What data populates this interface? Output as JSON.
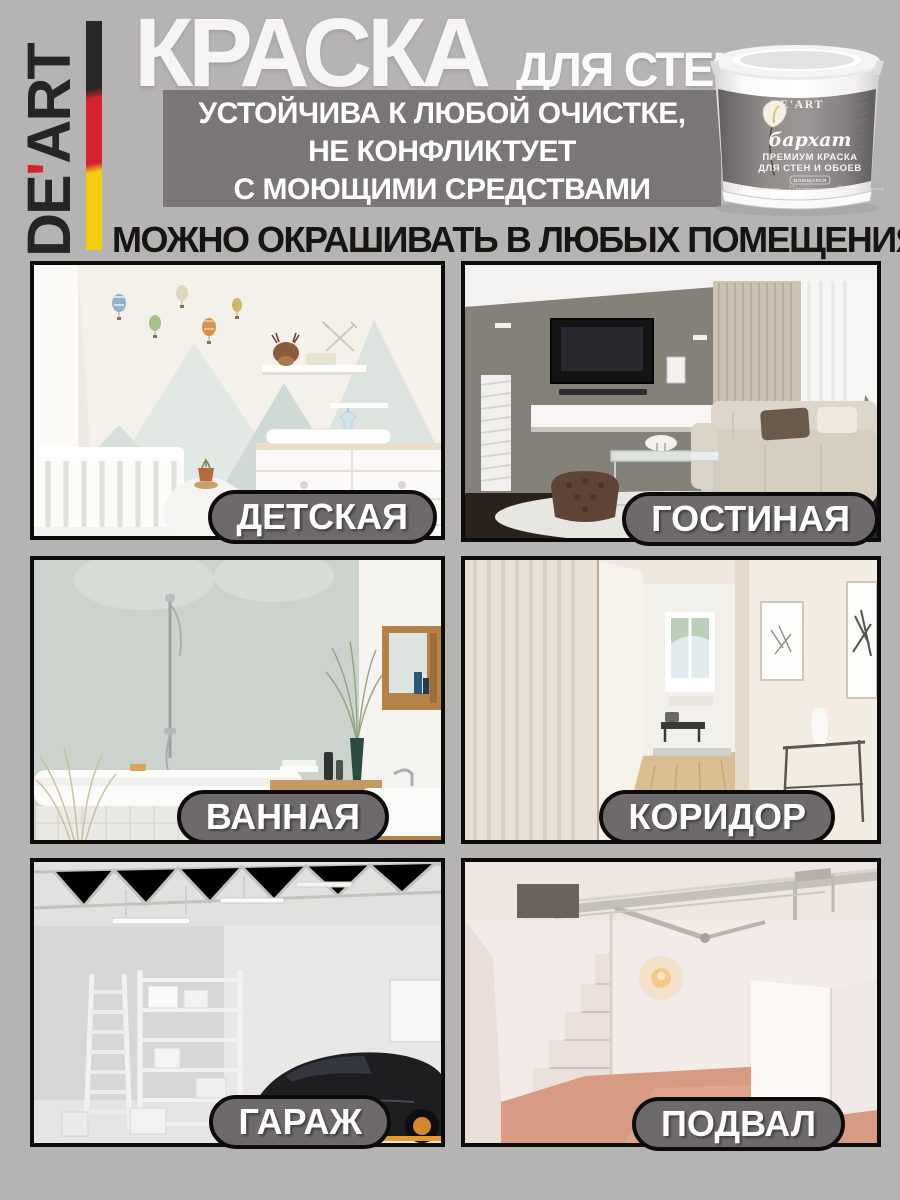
{
  "brand": {
    "name_prefix": "DE",
    "apostrophe": "'",
    "name_suffix": "ART",
    "flag_colors": {
      "black": "#2a2928",
      "red": "#d6212e",
      "yellow": "#f3cf12"
    }
  },
  "header": {
    "title_main": "КРАСКА",
    "title_sub": "ДЛЯ СТЕН",
    "benefit_line1": "УСТОЙЧИВА К ЛЮБОЙ ОЧИСТКЕ,",
    "benefit_line2": "НЕ КОНФЛИКТУЕТ",
    "benefit_line3": "С МОЮЩИМИ СРЕДСТВАМИ",
    "benefit_bg": "#7a7677"
  },
  "headline": "МОЖНО ОКРАШИВАТЬ В ЛЮБЫХ ПОМЕЩЕНИЯХ",
  "product": {
    "brand": "DE'ART",
    "series": "бархат",
    "type_line1": "ПРЕМИУМ КРАСКА",
    "type_line2": "ДЛЯ СТЕН И ОБОЕВ",
    "badge": "МОЮЩАЯСЯ",
    "feature1": "Устойчива к мытью",
    "feature2": "Без резкого запаха",
    "feature3": "Полная укрывистость"
  },
  "rooms": [
    {
      "id": "nursery",
      "label": "ДЕТСКАЯ"
    },
    {
      "id": "living-room",
      "label": "ГОСТИНАЯ"
    },
    {
      "id": "bathroom",
      "label": "ВАННАЯ"
    },
    {
      "id": "corridor",
      "label": "КОРИДОР"
    },
    {
      "id": "garage",
      "label": "ГАРАЖ"
    },
    {
      "id": "basement",
      "label": "ПОДВАЛ"
    }
  ],
  "label_style": {
    "bg": "#6e6a6b",
    "border": "#0c0c0c",
    "text": "#ffffff"
  }
}
